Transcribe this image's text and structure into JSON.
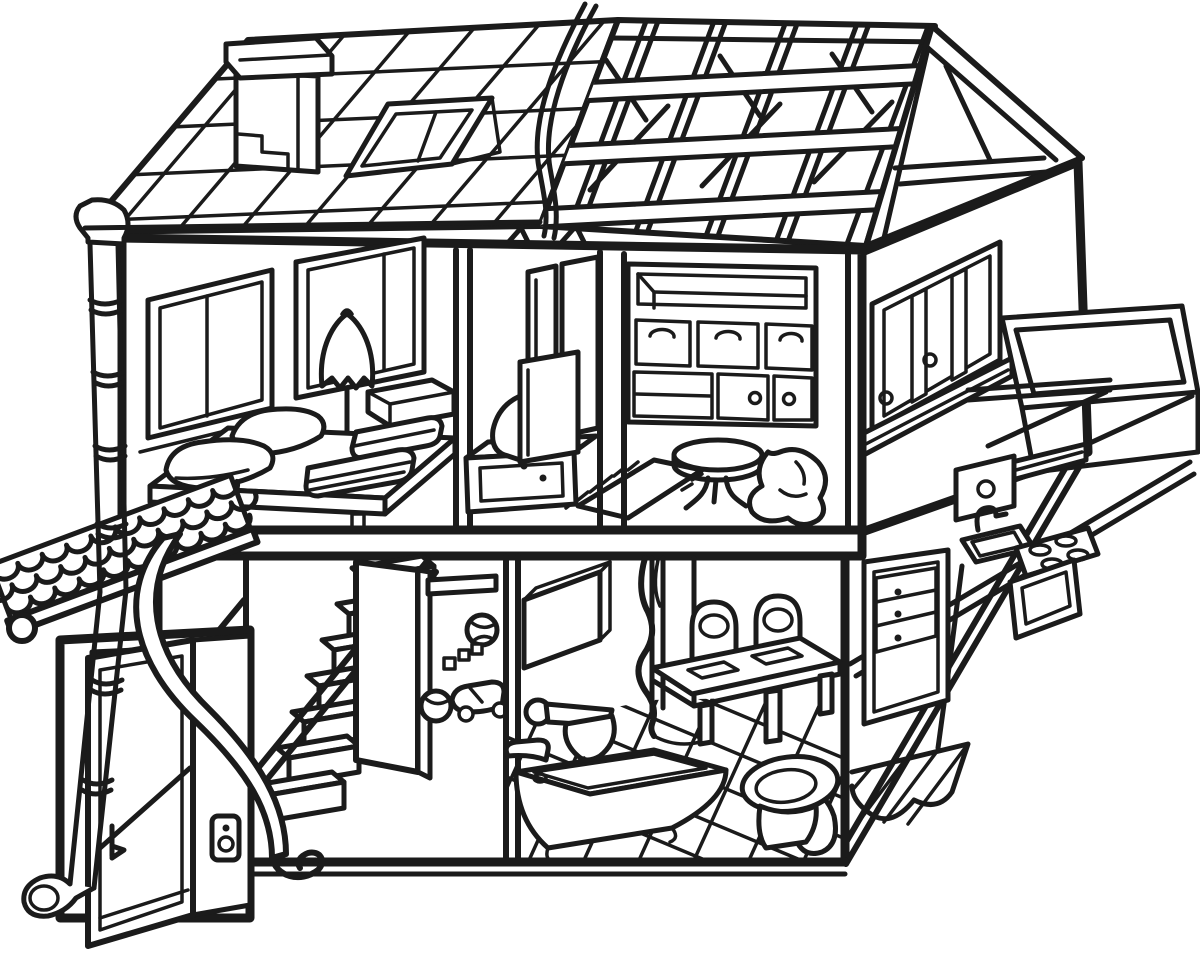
{
  "artwork": {
    "kind": "black-and-white coloring-page line drawing",
    "subject": "two-story dollhouse cutaway showing furnished rooms",
    "palette": {
      "line": "#1b1b1b",
      "background": "#ffffff"
    }
  },
  "scene": {
    "roof": {
      "label": "roof",
      "items": {
        "tiled_roof": "tiled-roof-left",
        "chimney": "chimney",
        "skylight": "skylight-window",
        "timber_roof": "exposed-rafter-roof-right",
        "gable": "gable-end-framing",
        "cable": "hanging-cable",
        "gutter": "gutter-end-cap"
      }
    },
    "upper_floor": {
      "label": "upper-floor",
      "rooms": {
        "bedroom": {
          "label": "bedroom",
          "items": [
            "window-left",
            "window-right",
            "floor-lamp",
            "platform-bed",
            "pillows",
            "folded-blankets",
            "storage-box"
          ]
        },
        "media_room": {
          "label": "media-room",
          "items": [
            "tall-window",
            "crt-tv",
            "tv-stand",
            "fringed-rug"
          ]
        },
        "cabinet_room": {
          "label": "cabinet-room",
          "items": [
            "wall-unit-open-shelf",
            "drawer-row",
            "cabinet-doors",
            "round-pedestal-table",
            "beanbag"
          ]
        },
        "side_wall": {
          "label": "right-side-wall",
          "items": [
            "sliding-window",
            "window-sill",
            "balcony-railing",
            "balcony-strut"
          ]
        }
      }
    },
    "lower_floor": {
      "label": "lower-floor",
      "rooms": {
        "porch": {
          "label": "entry-porch",
          "items": [
            "scalloped-porch-roof",
            "slot-window",
            "open-front-door",
            "door-handle",
            "doorbell-panel",
            "downspout-pipe"
          ]
        },
        "stair_hall": {
          "label": "staircase-hall",
          "items": [
            "staircase-steps",
            "handrail",
            "curved-banister",
            "open-interior-door",
            "wall-slot-shelf",
            "beach-ball",
            "toy-blocks",
            "toy-car",
            "second-ball"
          ]
        },
        "bathroom": {
          "label": "bathroom",
          "items": [
            "mirror-cabinet",
            "wall-faucet-basin",
            "bathtub",
            "tub-faucet",
            "toilet",
            "diamond-tile-floor"
          ]
        },
        "dining_room": {
          "label": "dining-room",
          "items": [
            "curtain",
            "doorway",
            "dining-table",
            "placemats",
            "chair-left",
            "chair-right"
          ]
        },
        "kitchen": {
          "label": "kitchen",
          "items": [
            "refrigerator",
            "upper-cabinet",
            "hood-shelf",
            "sink-and-faucet",
            "stove-burners",
            "oven",
            "hatched-tile-floor",
            "open-wall-cut"
          ]
        }
      }
    }
  }
}
